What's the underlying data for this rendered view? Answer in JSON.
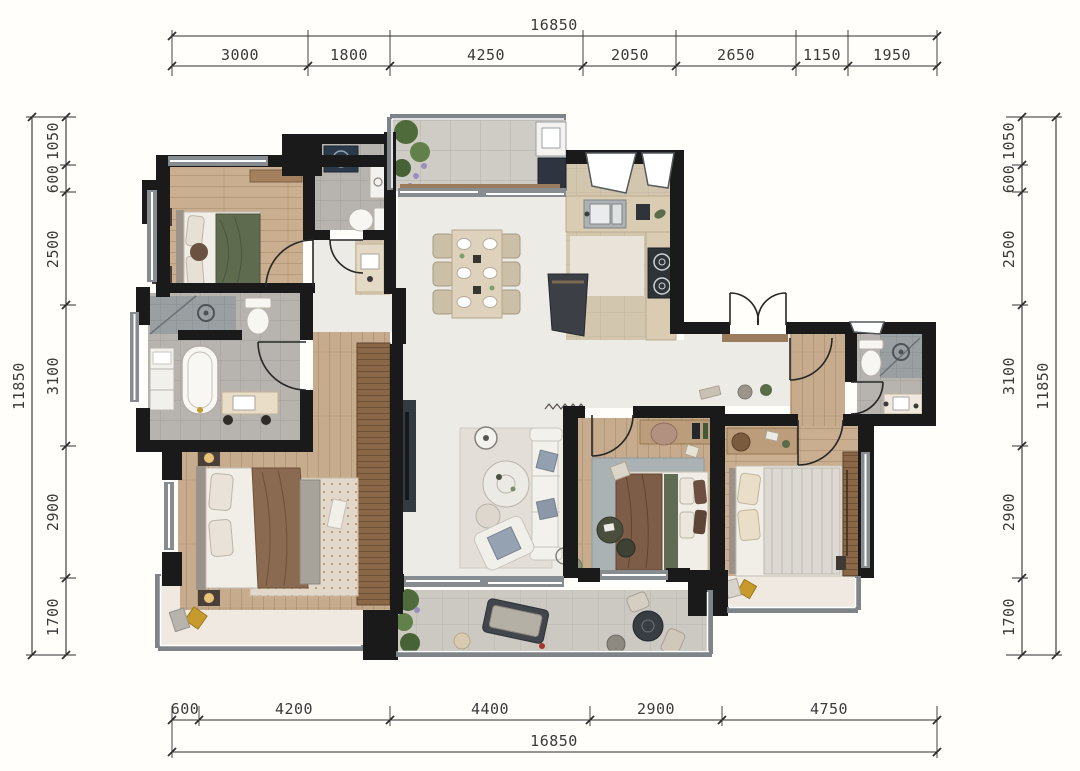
{
  "drawing": {
    "type": "apartment-floor-plan",
    "units": "mm"
  },
  "dimensions": {
    "top": {
      "overall": "16850",
      "segments": [
        "3000",
        "1800",
        "4250",
        "2050",
        "2650",
        "1150",
        "1950"
      ]
    },
    "bottom": {
      "overall": "16850",
      "segments": [
        "600",
        "4200",
        "4400",
        "2900",
        "4750"
      ]
    },
    "left": {
      "overall": "11850",
      "segments": [
        "1050",
        "600",
        "2500",
        "3100",
        "2900",
        "1700"
      ]
    },
    "right": {
      "overall": "11850",
      "segments": [
        "1050",
        "600",
        "2500",
        "3100",
        "2900",
        "1700"
      ]
    }
  },
  "colors": {
    "wall": "#1a1a1a",
    "window_frame": "#868c90",
    "wood_floor": "#c9ae90",
    "wood_dark": "#8a6847",
    "tile_gray": "#b7b3ae",
    "tile_balcony": "#cdcac4",
    "tile_beige": "#d3c6ae",
    "marble": "#edebe6",
    "accent_green": "#5f6b4f",
    "accent_brown": "#7d5d47",
    "accent_gold": "#c79a2e",
    "dim_line": "#2f2f2f"
  }
}
